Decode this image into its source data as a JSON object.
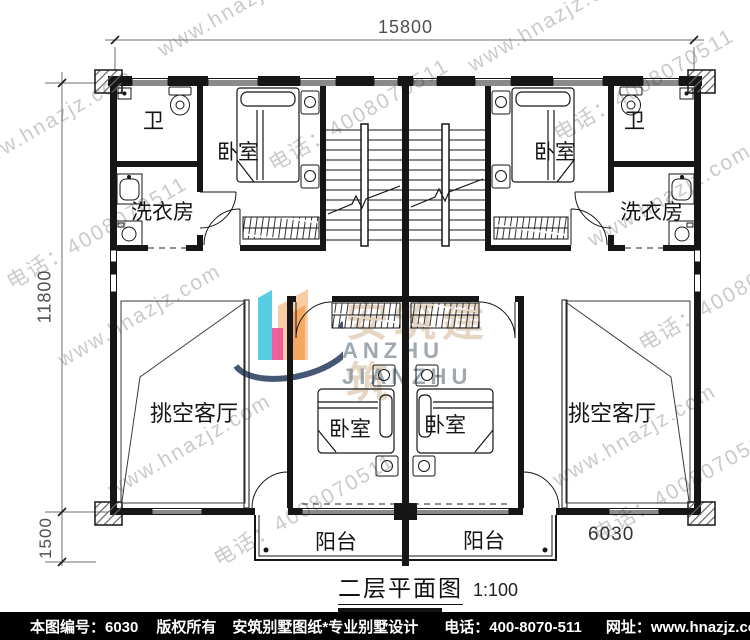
{
  "plan": {
    "title": "二层平面图",
    "scale": "1:100",
    "dims": {
      "top_width": "15800",
      "left_height": "11800",
      "balcony_depth": "1500",
      "balcony_width": "6030"
    }
  },
  "rooms": {
    "bathroom": "卫",
    "bedroom": "卧室",
    "laundry": "洗衣房",
    "living": "挑空客厅",
    "balcony": "阳台"
  },
  "watermark": {
    "site": "www.hnazjz.com",
    "phone": "电话：4008070511",
    "logo_cn": "安筑建筑",
    "logo_en": "ANZHU JIANZHU"
  },
  "footer": {
    "sheet": "本图编号：6030",
    "copyright": "版权所有",
    "brand": "安筑别墅图纸*专业别墅设计",
    "phone": "电话：400-8070-511",
    "site": "网址：www.hnazjz.com"
  },
  "colors": {
    "line": "#161616",
    "dimension": "#6f6f6f",
    "watermark": "#969696",
    "footer_bg": "#000000",
    "footer_text": "#ffffff",
    "logo_cyan": "#45c6e0",
    "logo_peach": "#f8c9a0",
    "logo_orange": "#f5a55f",
    "logo_pink": "#ef4f98",
    "logo_swoosh": "#24395c"
  }
}
